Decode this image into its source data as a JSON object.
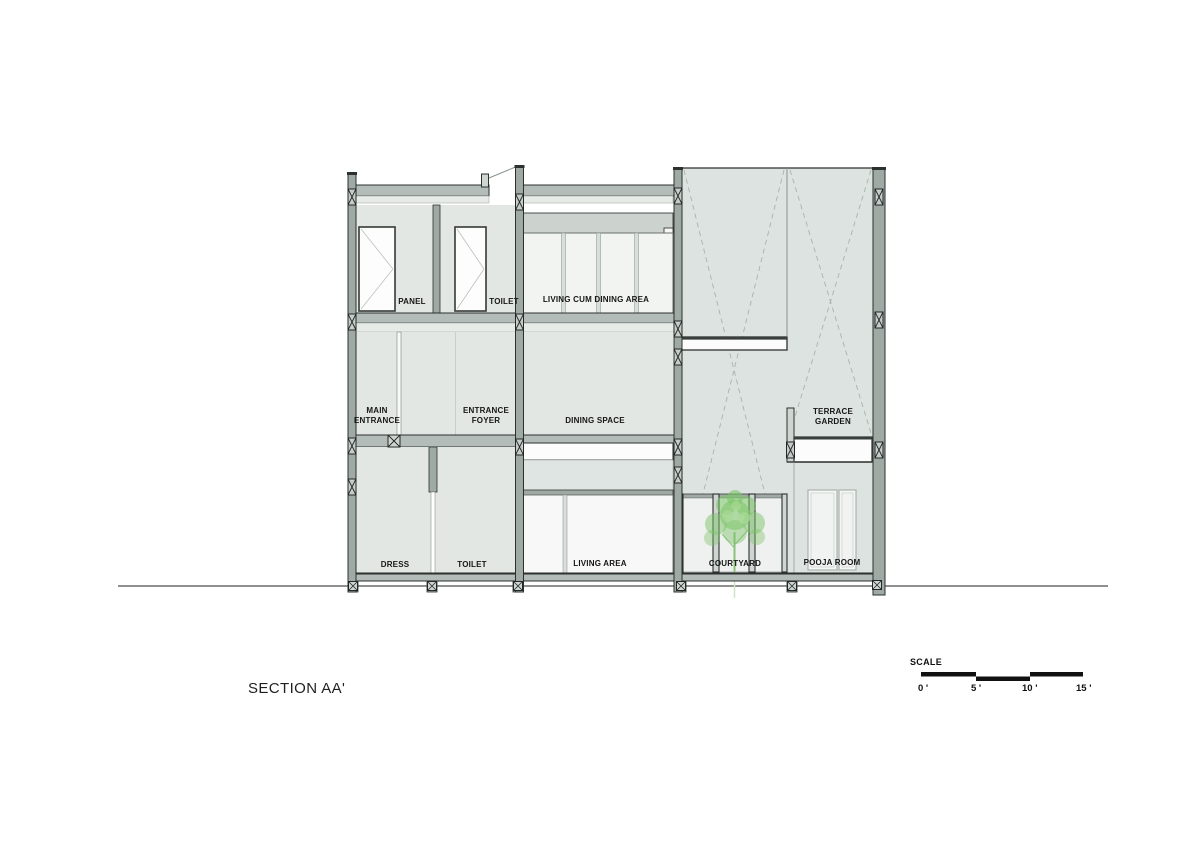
{
  "title": "SECTION AA'",
  "scale": {
    "label": "SCALE",
    "ticks": [
      "0 '",
      "5 '",
      "10 '",
      "15 '"
    ]
  },
  "labels": {
    "panel": "PANEL",
    "toilet_upper": "TOILET",
    "living_cum_dining": "LIVING CUM DINING AREA",
    "main_entrance": "MAIN\nENTRANCE",
    "entrance_foyer": "ENTRANCE\nFOYER",
    "dining_space": "DINING SPACE",
    "terrace_garden": "TERRACE\nGARDEN",
    "dress": "DRESS",
    "toilet_lower": "TOILET",
    "living_area": "LIVING AREA",
    "courtyard": "COURTYARD",
    "pooja_room": "POOJA ROOM"
  },
  "colors": {
    "wall_fill": "#9faaa5",
    "slab_fill": "#b3bcb8",
    "room_fill": "#e2e7e4",
    "room_fill_right": "#dde3e0",
    "line_dark": "#2c312f",
    "tree_green": "#7cc468",
    "bar_black": "#111111"
  }
}
